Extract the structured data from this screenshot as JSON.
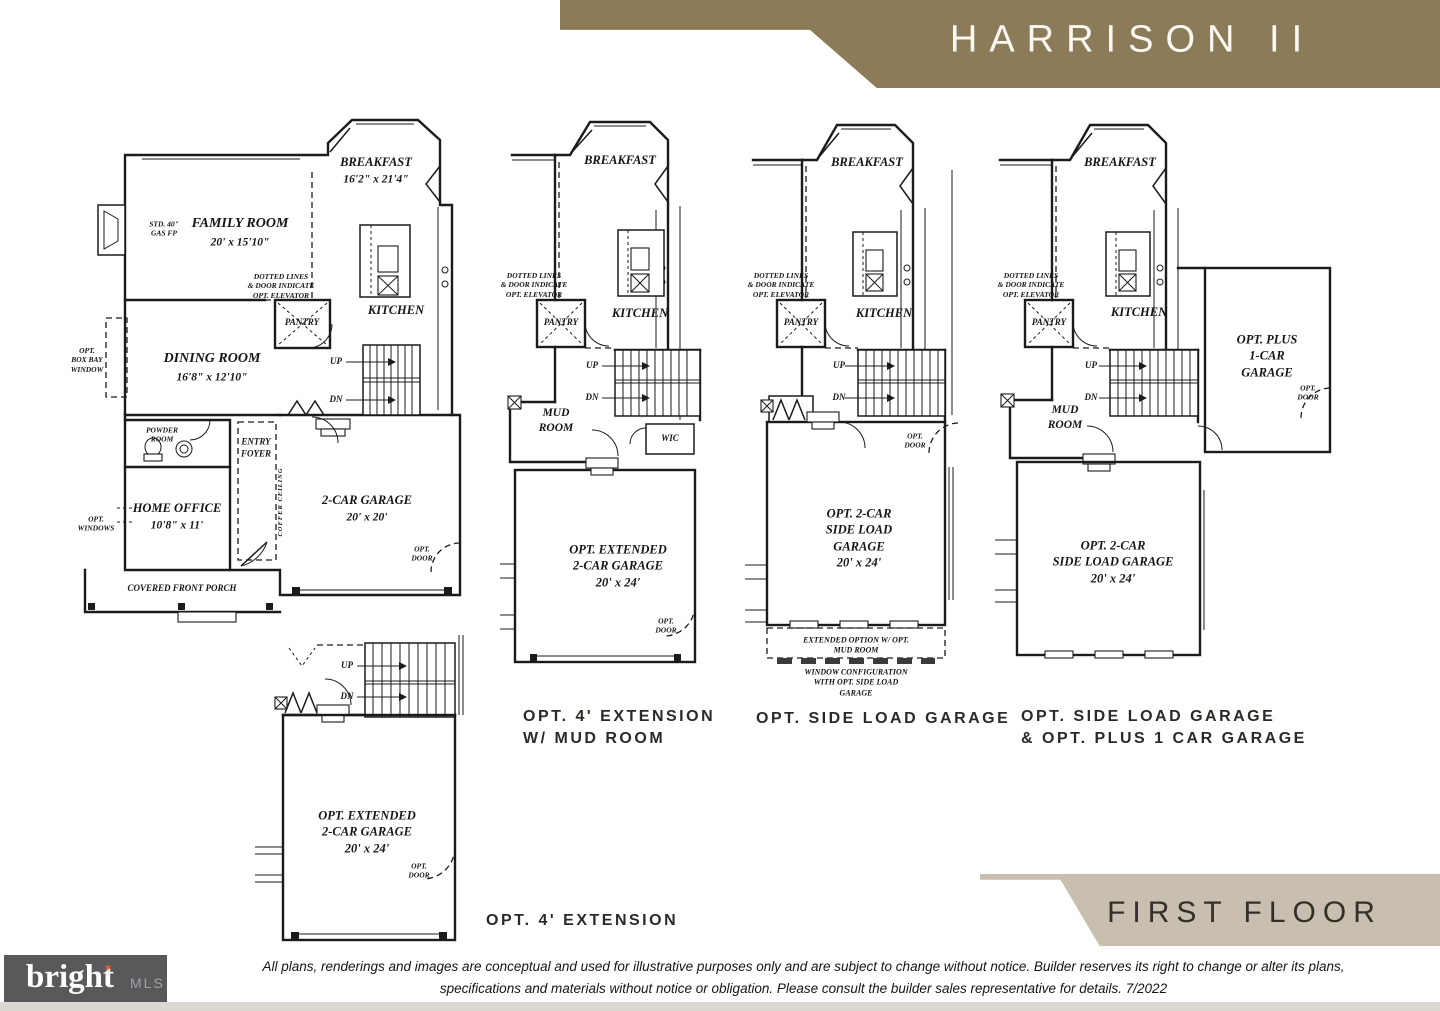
{
  "header": {
    "title": "HARRISON II"
  },
  "colors": {
    "banner_brown": "#8b7b59",
    "banner_tan": "#c8bfb0",
    "logo_bg": "#58595b",
    "logo_accent": "#e8653c",
    "ink": "#1b1b1b",
    "bottom_strip": "#dbd8d2"
  },
  "shared": {
    "breakfast": "BREAKFAST",
    "kitchen": "KITCHEN",
    "pantry": "PANTRY",
    "mud_room": "MUD\nROOM",
    "up": "UP",
    "dn": "DN",
    "opt_door": "OPT.\nDOOR",
    "elevator_note": "DOTTED LINES\n& DOOR INDICATE\nOPT. ELEVATOR",
    "ext_garage": "OPT. EXTENDED\n2-CAR GARAGE\n20' x 24'",
    "side_garage": "OPT. 2-CAR\nSIDE LOAD GARAGE\n20' x 24'"
  },
  "plan_main": {
    "breakfast_dims": "16'2\" x 21'4\"",
    "family_room": "FAMILY ROOM",
    "family_room_dims": "20' x 15'10\"",
    "gas_fp": "STD. 40\"\nGAS FP",
    "dining_room": "DINING ROOM",
    "dining_room_dims": "16'8\" x 12'10\"",
    "box_bay_window": "OPT.\nBOX BAY\nWINDOW",
    "powder_room": "POWDER\nROOM",
    "home_office": "HOME OFFICE",
    "home_office_dims": "10'8\" x 11'",
    "entry_foyer": "ENTRY\nFOYER",
    "coffer_ceiling": "COFFER CEILING",
    "opt_windows": "OPT.\nWINDOWS",
    "garage": "2-CAR GARAGE",
    "garage_dims": "20' x 20'",
    "porch": "COVERED FRONT PORCH"
  },
  "plan_ext": {
    "wic": "WIC"
  },
  "plan_side": {
    "note1": "EXTENDED OPTION W/ OPT. MUD ROOM",
    "note2": "WINDOW CONFIGURATION\nWITH OPT. SIDE LOAD GARAGE"
  },
  "plan_side_plus": {
    "plus_garage": "OPT. PLUS\n1-CAR GARAGE"
  },
  "captions": {
    "ext_mud": "OPT. 4' EXTENSION\nW/ MUD ROOM",
    "side": "OPT. SIDE LOAD GARAGE",
    "side_plus": "OPT. SIDE LOAD GARAGE\n& OPT. PLUS 1 CAR GARAGE",
    "ext": "OPT. 4' EXTENSION"
  },
  "footer": {
    "floor_label": "FIRST FLOOR",
    "logo": {
      "brand": "bright",
      "suffix": "MLS"
    },
    "disclaimer1": "All plans, renderings and images are conceptual and used for illustrative purposes only and are subject to change without notice. Builder reserves its right to change or alter its plans,",
    "disclaimer2": "specifications and materials without notice or obligation. Please consult the builder sales representative for details.  7/2022"
  }
}
